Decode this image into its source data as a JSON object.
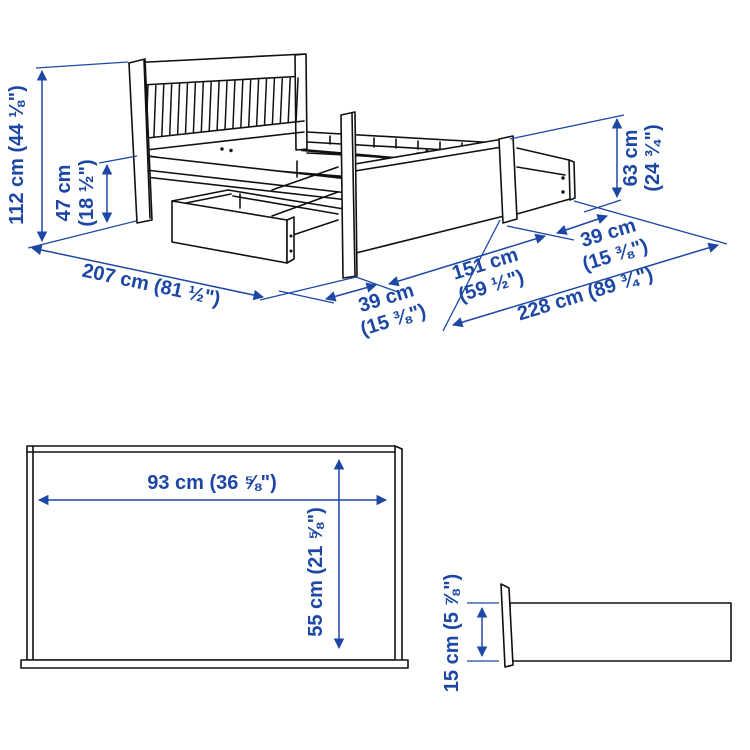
{
  "diagram": {
    "subject": "bed frame with storage drawers - measurement diagram",
    "colors": {
      "accent_blue": "#1c47a5",
      "line_black": "#111111",
      "background": "#ffffff"
    },
    "dimensions": {
      "headboard_height": {
        "label": "112 cm (44 ⅛\")"
      },
      "side_rail_height": {
        "line1": "47 cm",
        "line2": "(18 ½\")"
      },
      "bed_length": {
        "label": "207 cm (81 ½\")"
      },
      "drawer_clearance_near": {
        "line1": "39 cm",
        "line2": "(15 ⅜\")"
      },
      "bed_width": {
        "line1": "151 cm",
        "line2": "(59 ½\")"
      },
      "drawer_clearance_far": {
        "line1": "39 cm",
        "line2": "(15 ⅜\")"
      },
      "total_width_with_drawers": {
        "label": "228 cm (89 ¾\")"
      },
      "footboard_height": {
        "line1": "63 cm",
        "line2": "(24 ¾\")"
      },
      "drawer_front_width": {
        "label": "93 cm (36 ⅝\")"
      },
      "drawer_front_height": {
        "label": "55 cm (21 ⅝\")"
      },
      "drawer_box_height": {
        "label": "15 cm (5 ⅞\")"
      }
    }
  }
}
